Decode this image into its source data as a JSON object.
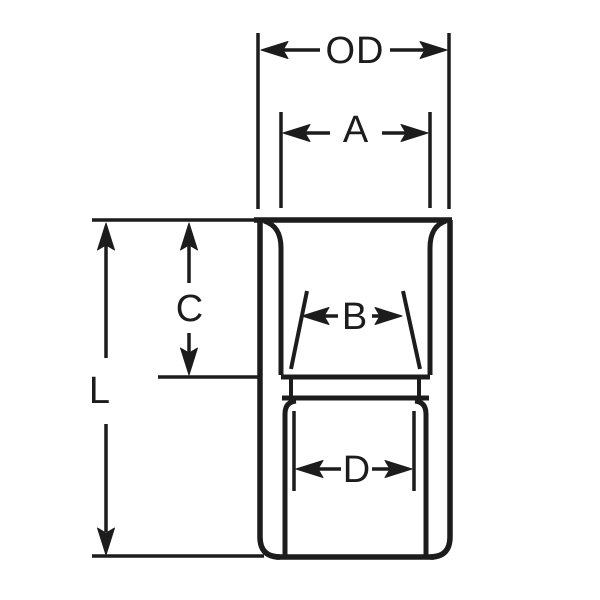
{
  "figure": {
    "kind": "cross-section dimension drawing",
    "labels": {
      "od": "OD",
      "a": "A",
      "b": "B",
      "c": "C",
      "d": "D",
      "l": "L"
    },
    "colors": {
      "ink": "#1c1c1c",
      "paper": "#ffffff"
    }
  }
}
